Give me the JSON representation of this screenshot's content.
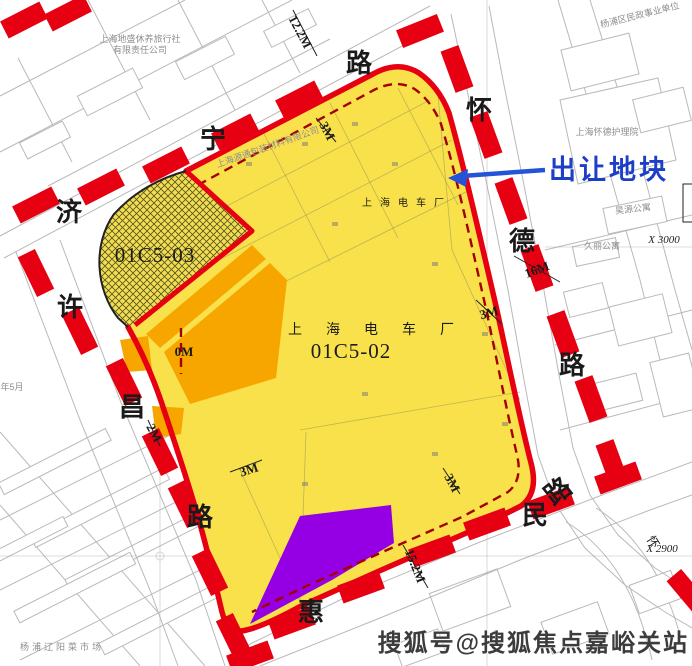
{
  "map": {
    "annotation": {
      "label": "出让地块"
    },
    "parcels": {
      "main": {
        "id": "01C5-02",
        "owner": "上海电车厂",
        "owner_top": "上海电车厂"
      },
      "sub": {
        "id": "01C5-03"
      }
    },
    "roads": {
      "jining": {
        "name": "济宁路",
        "chars": [
          "济",
          "宁",
          "路"
        ]
      },
      "huaide": {
        "name": "怀德路",
        "chars": [
          "怀",
          "德",
          "路"
        ],
        "extra_char": "怀"
      },
      "xuchang": {
        "name": "许昌路",
        "chars": [
          "许",
          "昌",
          "路"
        ]
      },
      "huimin": {
        "name": "惠民路",
        "chars": [
          "惠",
          "民",
          "路"
        ]
      }
    },
    "measurements": {
      "top_road_width": "12.2M",
      "top_setback": "3M",
      "right_road_width": "16M",
      "right_setback": "3M",
      "left_setback": "0M",
      "left_edge": "2M",
      "bottom_left_setback": "3M",
      "bottom_setback": "3M",
      "bottom_road_width": "15.2M"
    },
    "landmarks": {
      "resort_line1": "上海地盛休养旅行社",
      "resort_line2": "有限责任公司",
      "packaging": "上海源通包装材料有限公司",
      "nursing_home": "上海怀德护理院",
      "civil_affairs": "杨浦区民政事业单位",
      "apartment1": "昊源公寓",
      "apartment2": "久丽公寓",
      "market": "杨浦辽阳菜市场",
      "date_note": "2018年5月"
    },
    "grid_refs": {
      "x3000": "X 3000",
      "x2900": "X 2900"
    },
    "watermark": "搜狐号@搜狐焦点嘉峪关站",
    "colors": {
      "parcel_yellow": "#f8e14b",
      "orange": "#f7a600",
      "purple": "#9400e3",
      "boundary_red": "#e60012",
      "annotation_blue": "#1d3fc8"
    }
  }
}
